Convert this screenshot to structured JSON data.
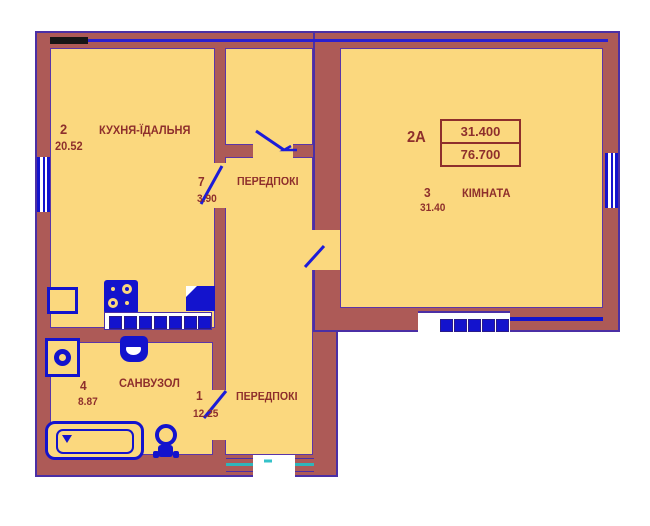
{
  "plan": {
    "unit_label": "2А",
    "area_table": {
      "upper": "31.400",
      "lower": "76.700"
    },
    "rooms": {
      "kitchen": {
        "number": "2",
        "area": "20.52",
        "name": "КУХНЯ-ЇДАЛЬНЯ"
      },
      "hall7": {
        "number": "7",
        "area": "3.90",
        "name": "ПЕРЕДПОКІ"
      },
      "living": {
        "number": "3",
        "area": "31.40",
        "name": "КІМНАТА"
      },
      "bathroom": {
        "number": "4",
        "area": "8.87",
        "name": "САНВУЗОЛ"
      },
      "hall1": {
        "number": "1",
        "area": "12.25",
        "name": "ПЕРЕДПОКІ"
      }
    },
    "fixtures": [
      "fridge",
      "stove",
      "kitchen-sink",
      "kitchen-counter",
      "washing-machine",
      "wash-basin",
      "bathtub",
      "toilet"
    ],
    "colors": {
      "wall": "#ad5a57",
      "room_fill": "#fbd87e",
      "outline": "#4b2fa5",
      "fixture_blue": "#1313cd",
      "label_text": "#8e2f2c",
      "entrance_teal": "#2fb5ba",
      "window_glass": "#ffffff",
      "mark_black": "#151515"
    }
  }
}
